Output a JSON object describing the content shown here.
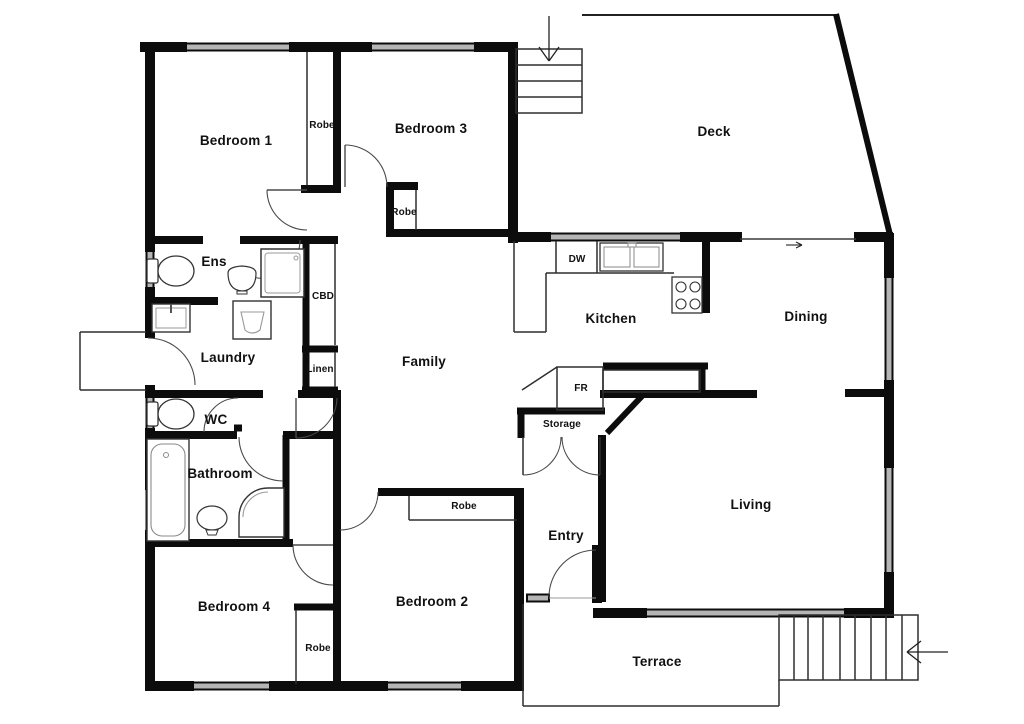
{
  "colors": {
    "background": "#ffffff",
    "wall": "#0c0c0c",
    "thin_line": "#2e2e2e",
    "window": "#b5b5b5",
    "fixture_line": "#808080",
    "label": "#111111"
  },
  "floor_plan": {
    "rooms": [
      {
        "id": "bedroom1",
        "label": "Bedroom 1"
      },
      {
        "id": "robe1",
        "label": "Robe"
      },
      {
        "id": "bedroom3",
        "label": "Bedroom 3"
      },
      {
        "id": "robe3",
        "label": "Robe"
      },
      {
        "id": "deck",
        "label": "Deck"
      },
      {
        "id": "ens",
        "label": "Ens"
      },
      {
        "id": "cbd",
        "label": "CBD"
      },
      {
        "id": "laundry",
        "label": "Laundry"
      },
      {
        "id": "linen",
        "label": "Linen"
      },
      {
        "id": "family",
        "label": "Family"
      },
      {
        "id": "kitchen",
        "label": "Kitchen"
      },
      {
        "id": "dw",
        "label": "DW"
      },
      {
        "id": "dining",
        "label": "Dining"
      },
      {
        "id": "wc",
        "label": "WC"
      },
      {
        "id": "bathroom",
        "label": "Bathroom"
      },
      {
        "id": "fr",
        "label": "FR"
      },
      {
        "id": "storage",
        "label": "Storage"
      },
      {
        "id": "living",
        "label": "Living"
      },
      {
        "id": "entry",
        "label": "Entry"
      },
      {
        "id": "bedroom4",
        "label": "Bedroom 4"
      },
      {
        "id": "robe4",
        "label": "Robe"
      },
      {
        "id": "bedroom2",
        "label": "Bedroom 2"
      },
      {
        "id": "robe2",
        "label": "Robe"
      },
      {
        "id": "terrace",
        "label": "Terrace"
      }
    ],
    "fixtures": [
      "toilet-icon",
      "shower-icon",
      "corner-shower-icon",
      "bathtub-icon",
      "basin-icon",
      "laundry-sink-icon",
      "laundry-trough-icon",
      "double-sink-icon",
      "cooktop-icon"
    ],
    "stairs": {
      "deck_steps": 4,
      "terrace_steps": 9
    },
    "arrows": [
      "down-arrow-deck-stairs",
      "right-arrow-sliding-door",
      "left-arrow-terrace-stairs"
    ]
  }
}
